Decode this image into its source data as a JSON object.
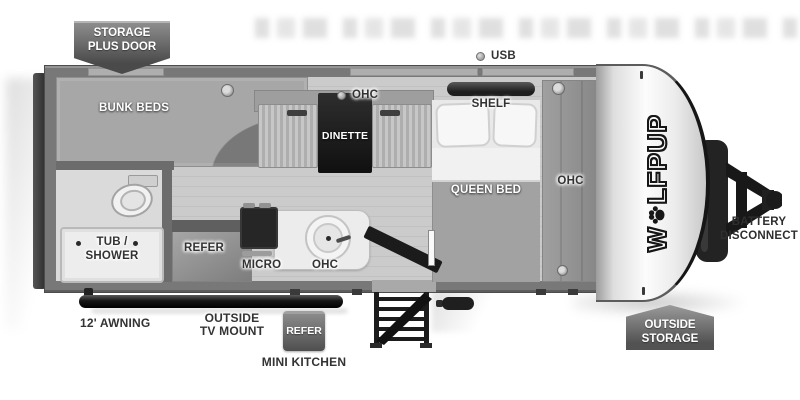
{
  "colors": {
    "badge_dark": "#4f4f4f",
    "badge_light": "#8d8d8d",
    "wall_gray": "#787878",
    "floor_gray": "#c9c9c9",
    "fixture_dark": "#1e1e1e",
    "label_dark": "#333333",
    "label_white": "#ffffff"
  },
  "exterior": {
    "storage_plus_door_badge": {
      "line1": "STORAGE",
      "line2": "PLUS DOOR"
    },
    "usb_label": "USB",
    "awning_label": "12' AWNING",
    "outside_tv_mount": {
      "line1": "OUTSIDE",
      "line2": "TV MOUNT"
    },
    "mini_kitchen": {
      "badge_label": "REFER",
      "caption": "MINI KITCHEN"
    },
    "outside_storage_badge": {
      "line1": "OUTSIDE",
      "line2": "STORAGE"
    },
    "battery_disconnect": {
      "line1": "BATTERY",
      "line2": "DISCONNECT"
    },
    "brand_logo": {
      "first_letter": "W",
      "rest": "LFPUP",
      "o_symbol": "paw-print"
    }
  },
  "interior": {
    "bunk_beds": "BUNK BEDS",
    "dinette_ohc": "OHC",
    "dinette": "DINETTE",
    "shelf": "SHELF",
    "queen_bed": "QUEEN BED",
    "wardrobe_ohc": "OHC",
    "tub_shower": {
      "line1": "TUB /",
      "line2": "SHOWER"
    },
    "refer": "REFER",
    "micro": "MICRO",
    "kitchen_ohc": "OHC"
  }
}
